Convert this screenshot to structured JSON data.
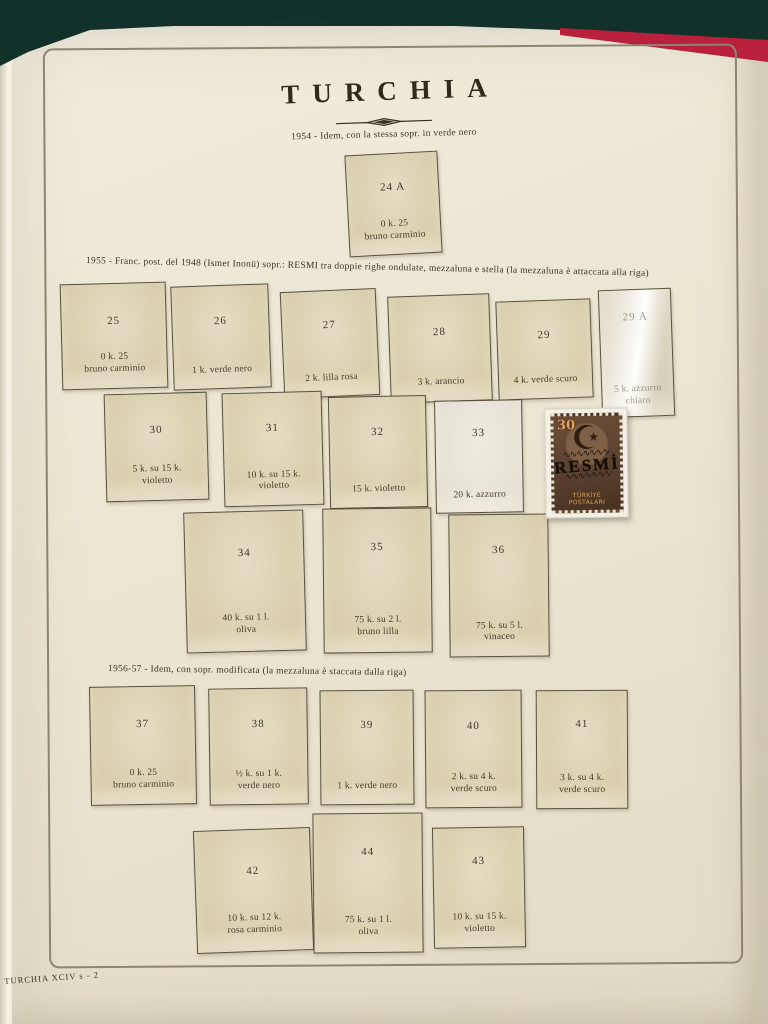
{
  "album_page": {
    "title": "TURCHIA",
    "footer": "TURCHIA XCIV s - 2",
    "colors": {
      "background": "#14332d",
      "book_cover_red": "#b9203c",
      "page": "#ece6d3",
      "box_fill": "#d8ceae",
      "ink": "#3a3425"
    }
  },
  "sections": [
    {
      "caption": "1954 - Idem, con la stessa sopr. in verde nero",
      "boxes": [
        {
          "id": "24A",
          "num": "24 A",
          "line1": "0 k. 25",
          "line2": "bruno carminio"
        }
      ]
    },
    {
      "caption": "1955 - Franc. post. del 1948 (Ismet Inonü) sopr.: RESMI tra doppie righe ondulate, mezzaluna e stella (la mezzaluna è attaccata alla riga)",
      "boxes": [
        {
          "id": "25",
          "num": "25",
          "line1": "0 k. 25",
          "line2": "bruno carminio"
        },
        {
          "id": "26",
          "num": "26",
          "line1": "1 k. verde nero",
          "line2": ""
        },
        {
          "id": "27",
          "num": "27",
          "line1": "2 k. lilla rosa",
          "line2": ""
        },
        {
          "id": "28",
          "num": "28",
          "line1": "3 k. arancio",
          "line2": ""
        },
        {
          "id": "29",
          "num": "29",
          "line1": "4 k. verde scuro",
          "line2": ""
        },
        {
          "id": "29A",
          "num": "29 A",
          "line1": "5 k. azzurro chiaro",
          "line2": "",
          "variant": "glossy"
        },
        {
          "id": "30",
          "num": "30",
          "line1": "5 k. su 15 k.",
          "line2": "violetto"
        },
        {
          "id": "31",
          "num": "31",
          "line1": "10 k. su 15 k.",
          "line2": "violetto"
        },
        {
          "id": "32",
          "num": "32",
          "line1": "15 k. violetto",
          "line2": ""
        },
        {
          "id": "33",
          "num": "33",
          "line1": "20 k. azzurro",
          "line2": "",
          "variant": "light"
        },
        {
          "id": "34",
          "num": "34",
          "line1": "40 k. su 1 l.",
          "line2": "oliva"
        },
        {
          "id": "35",
          "num": "35",
          "line1": "75 k. su 2 l.",
          "line2": "bruno lilla"
        },
        {
          "id": "36",
          "num": "36",
          "line1": "75 k. su 5 l.",
          "line2": "vinaceo"
        }
      ]
    },
    {
      "caption": "1956-57 - Idem, con sopr. modificata (la mezzaluna è staccata dalla riga)",
      "boxes": [
        {
          "id": "37",
          "num": "37",
          "line1": "0 k. 25",
          "line2": "bruno carminio"
        },
        {
          "id": "38",
          "num": "38",
          "line1": "½ k. su 1 k.",
          "line2": "verde nero"
        },
        {
          "id": "39",
          "num": "39",
          "line1": "1 k. verde nero",
          "line2": ""
        },
        {
          "id": "40",
          "num": "40",
          "line1": "2 k. su 4 k.",
          "line2": "verde scuro"
        },
        {
          "id": "41",
          "num": "41",
          "line1": "3 k. su 4 k.",
          "line2": "verde scuro"
        },
        {
          "id": "42",
          "num": "42",
          "line1": "10 k. su 12 k.",
          "line2": "rosa carminio"
        },
        {
          "id": "44",
          "num": "44",
          "line1": "75 k. su 1 l.",
          "line2": "oliva"
        },
        {
          "id": "43",
          "num": "43",
          "line1": "10 k. su 15 k.",
          "line2": "violetto"
        }
      ]
    }
  ],
  "mounted_stamp": {
    "value": "30",
    "emblem": "☪",
    "wave": "∿∿∿∿∿∿∿",
    "overprint": "RESMİ",
    "bottom_text": "TÜRKİYE POSTALARI",
    "color": "#5a4030"
  }
}
